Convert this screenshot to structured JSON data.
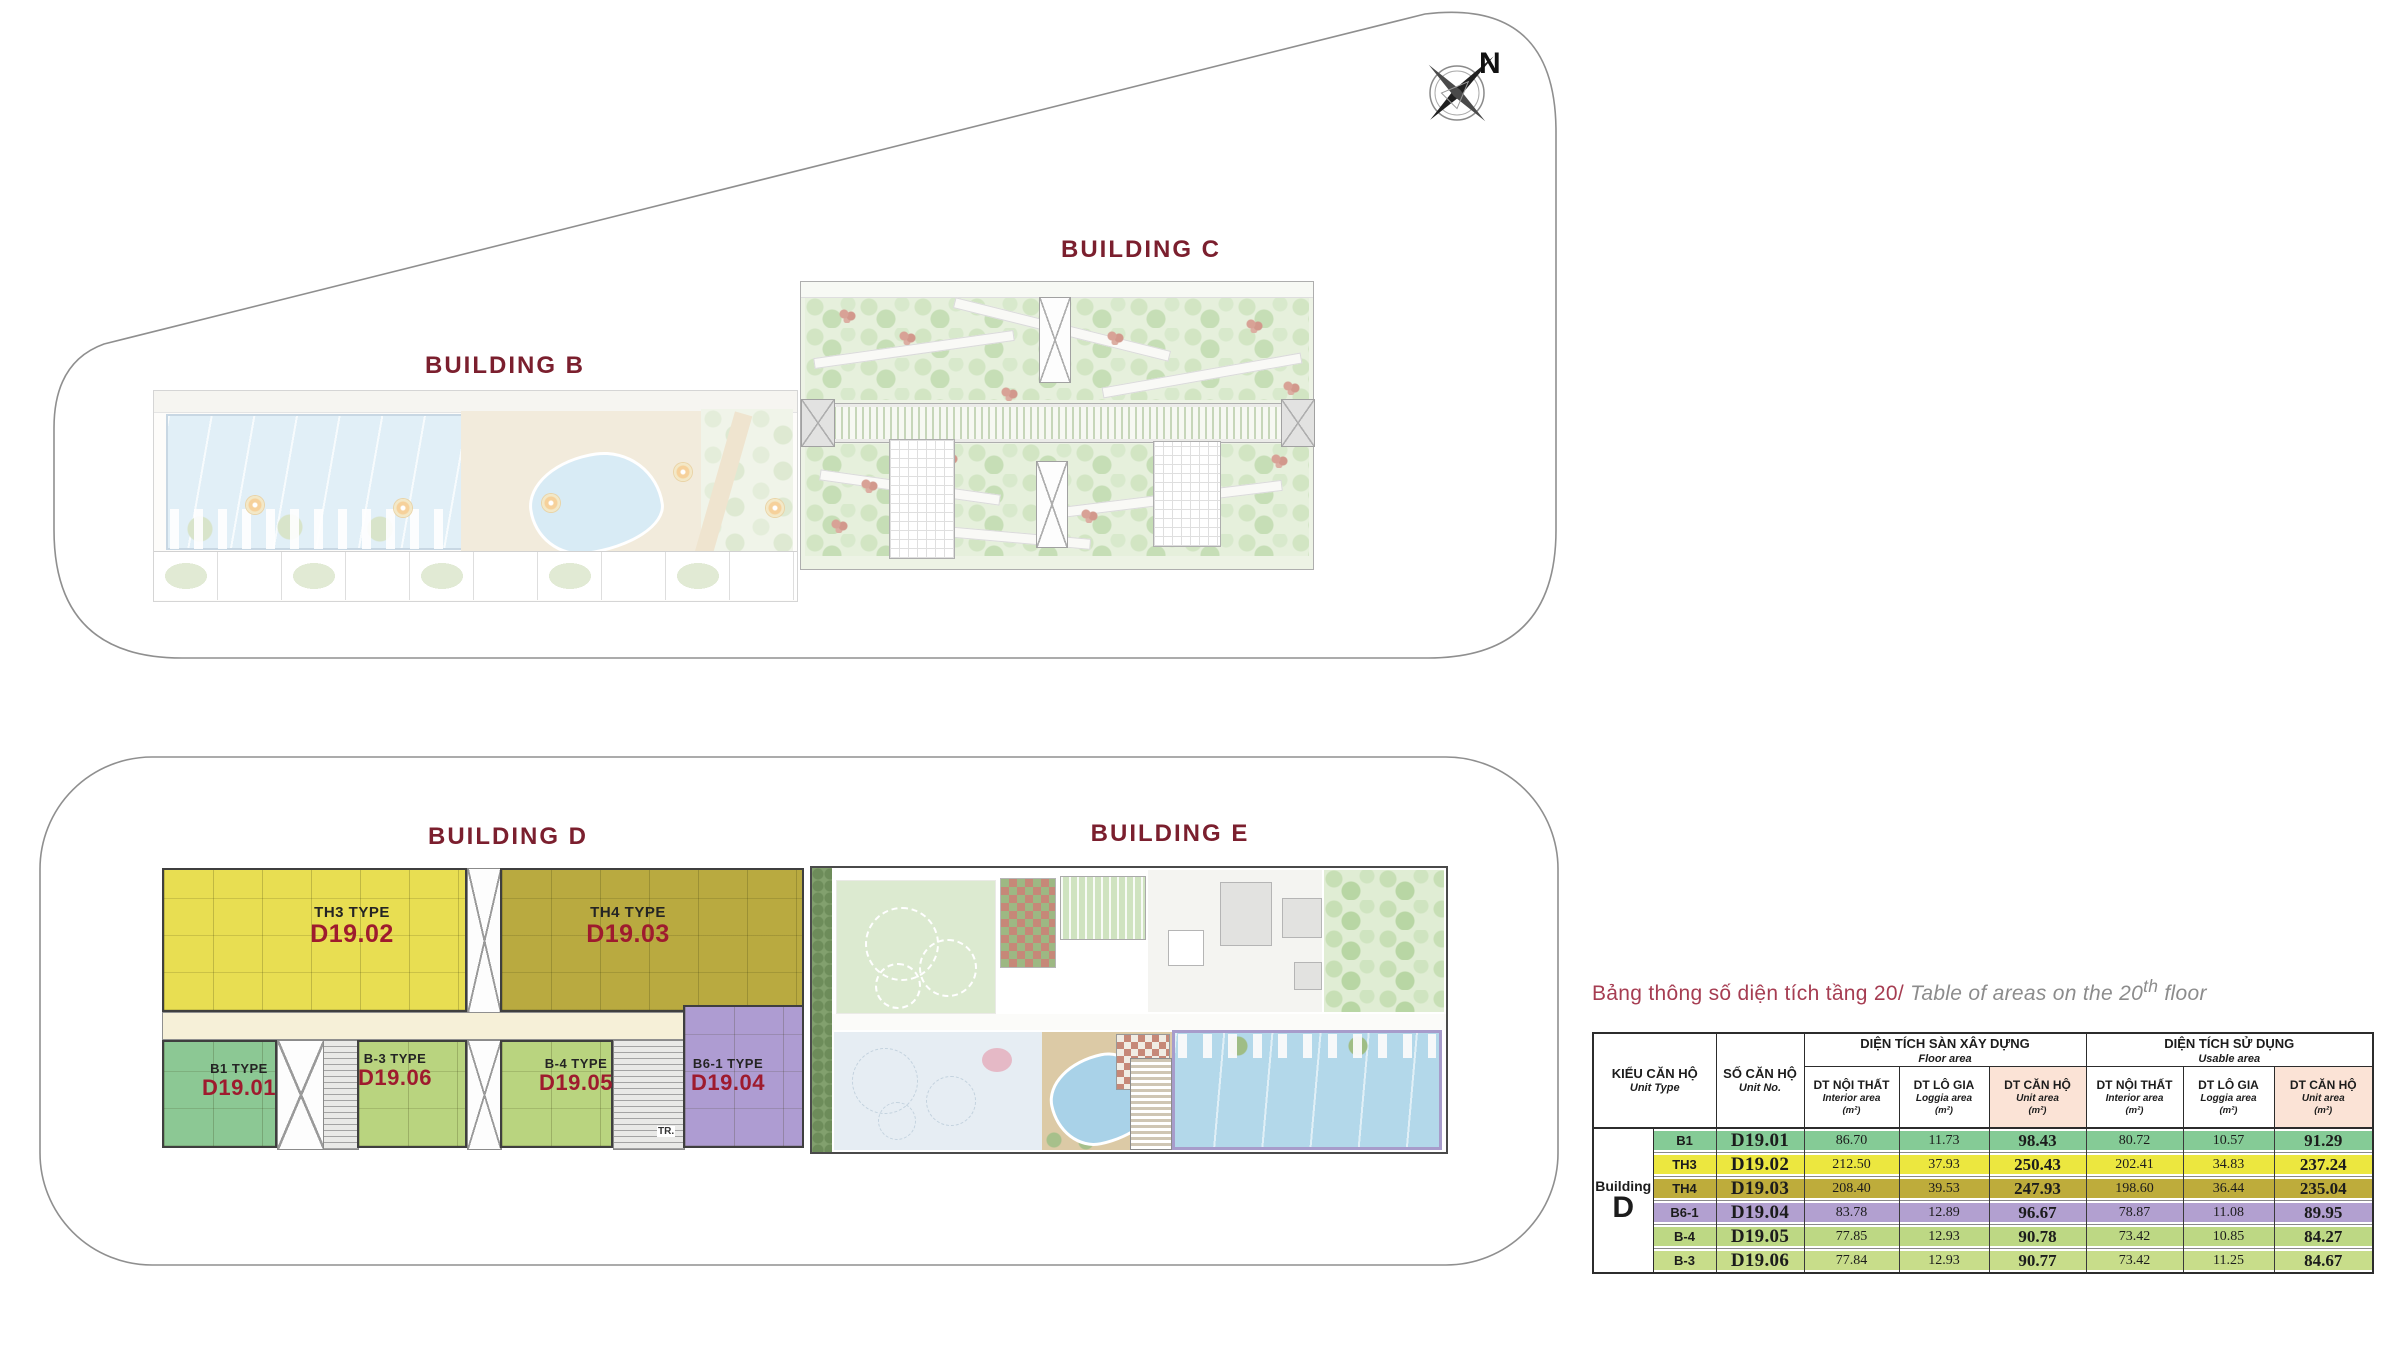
{
  "compass": {
    "label": "N"
  },
  "buildings": {
    "b": {
      "label": "BUILDING B"
    },
    "c": {
      "label": "BUILDING C"
    },
    "d": {
      "label": "BUILDING D"
    },
    "e": {
      "label": "BUILDING E"
    }
  },
  "units": {
    "th3": {
      "type_label": "TH3 TYPE",
      "unit_no": "D19.02"
    },
    "th4": {
      "type_label": "TH4 TYPE",
      "unit_no": "D19.03"
    },
    "b1": {
      "type_label": "B1 TYPE",
      "unit_no": "D19.01"
    },
    "b3": {
      "type_label": "B-3 TYPE",
      "unit_no": "D19.06"
    },
    "b4": {
      "type_label": "B-4 TYPE",
      "unit_no": "D19.05"
    },
    "b61": {
      "type_label": "B6-1 TYPE",
      "unit_no": "D19.04"
    }
  },
  "plan_d": {
    "stair_label": "TR."
  },
  "table": {
    "title": {
      "vi": "Bảng thông số diện tích tầng 20/",
      "en_pre": " Table of areas on the 20",
      "en_sup": "th",
      "en_post": " floor"
    },
    "header": {
      "unit_type_vi": "KIỂU CĂN HỘ",
      "unit_type_en": "Unit Type",
      "unit_no_vi": "SỐ CĂN HỘ",
      "unit_no_en": "Unit No.",
      "floor_vi": "DIỆN TÍCH SÀN XÂY DỰNG",
      "floor_en": "Floor area",
      "usable_vi": "DIỆN TÍCH SỬ DỤNG",
      "usable_en": "Usable area",
      "interior_vi": "DT NỘI THẤT",
      "interior_en": "Interior area",
      "loggia_vi": "DT LÔ GIA",
      "loggia_en": "Loggia area",
      "unit_area_vi": "DT CĂN HỘ",
      "unit_area_en": "Unit area",
      "m2": "(m²)"
    },
    "building_cell": {
      "line1": "Building",
      "line2": "D"
    },
    "rows": [
      [
        "B1",
        "D19.01",
        "86.70",
        "11.73",
        "98.43",
        "80.72",
        "10.57",
        "91.29"
      ],
      [
        "TH3",
        "D19.02",
        "212.50",
        "37.93",
        "250.43",
        "202.41",
        "34.83",
        "237.24"
      ],
      [
        "TH4",
        "D19.03",
        "208.40",
        "39.53",
        "247.93",
        "198.60",
        "36.44",
        "235.04"
      ],
      [
        "B6-1",
        "D19.04",
        "83.78",
        "12.89",
        "96.67",
        "78.87",
        "11.08",
        "89.95"
      ],
      [
        "B-4",
        "D19.05",
        "77.85",
        "12.93",
        "90.78",
        "73.42",
        "10.85",
        "84.27"
      ],
      [
        "B-3",
        "D19.06",
        "77.84",
        "12.93",
        "90.77",
        "73.42",
        "11.25",
        "84.67"
      ]
    ]
  },
  "colors": {
    "building_label": "#7b1f2e",
    "unit_number_red": "#9e1b2e",
    "title_rose": "#a63d52",
    "title_gray": "#8c8c8c",
    "row_b1": "#85cb96",
    "row_th3": "#ece73f",
    "row_th4": "#beac3b",
    "row_b61": "#b2a0d0",
    "row_b4": "#bdd884",
    "row_b3": "#c8dd8a",
    "unit_area_header_bg": "#fbe3d6",
    "plan_th3": "#e8de52",
    "plan_th4": "#b9aa40",
    "plan_b1": "#8cc894",
    "plan_b3_b4": "#b9d47f",
    "plan_b61": "#ae9cd2",
    "pool_blue": "#b3d8ea",
    "corridor_cream": "#f6f0d8"
  }
}
